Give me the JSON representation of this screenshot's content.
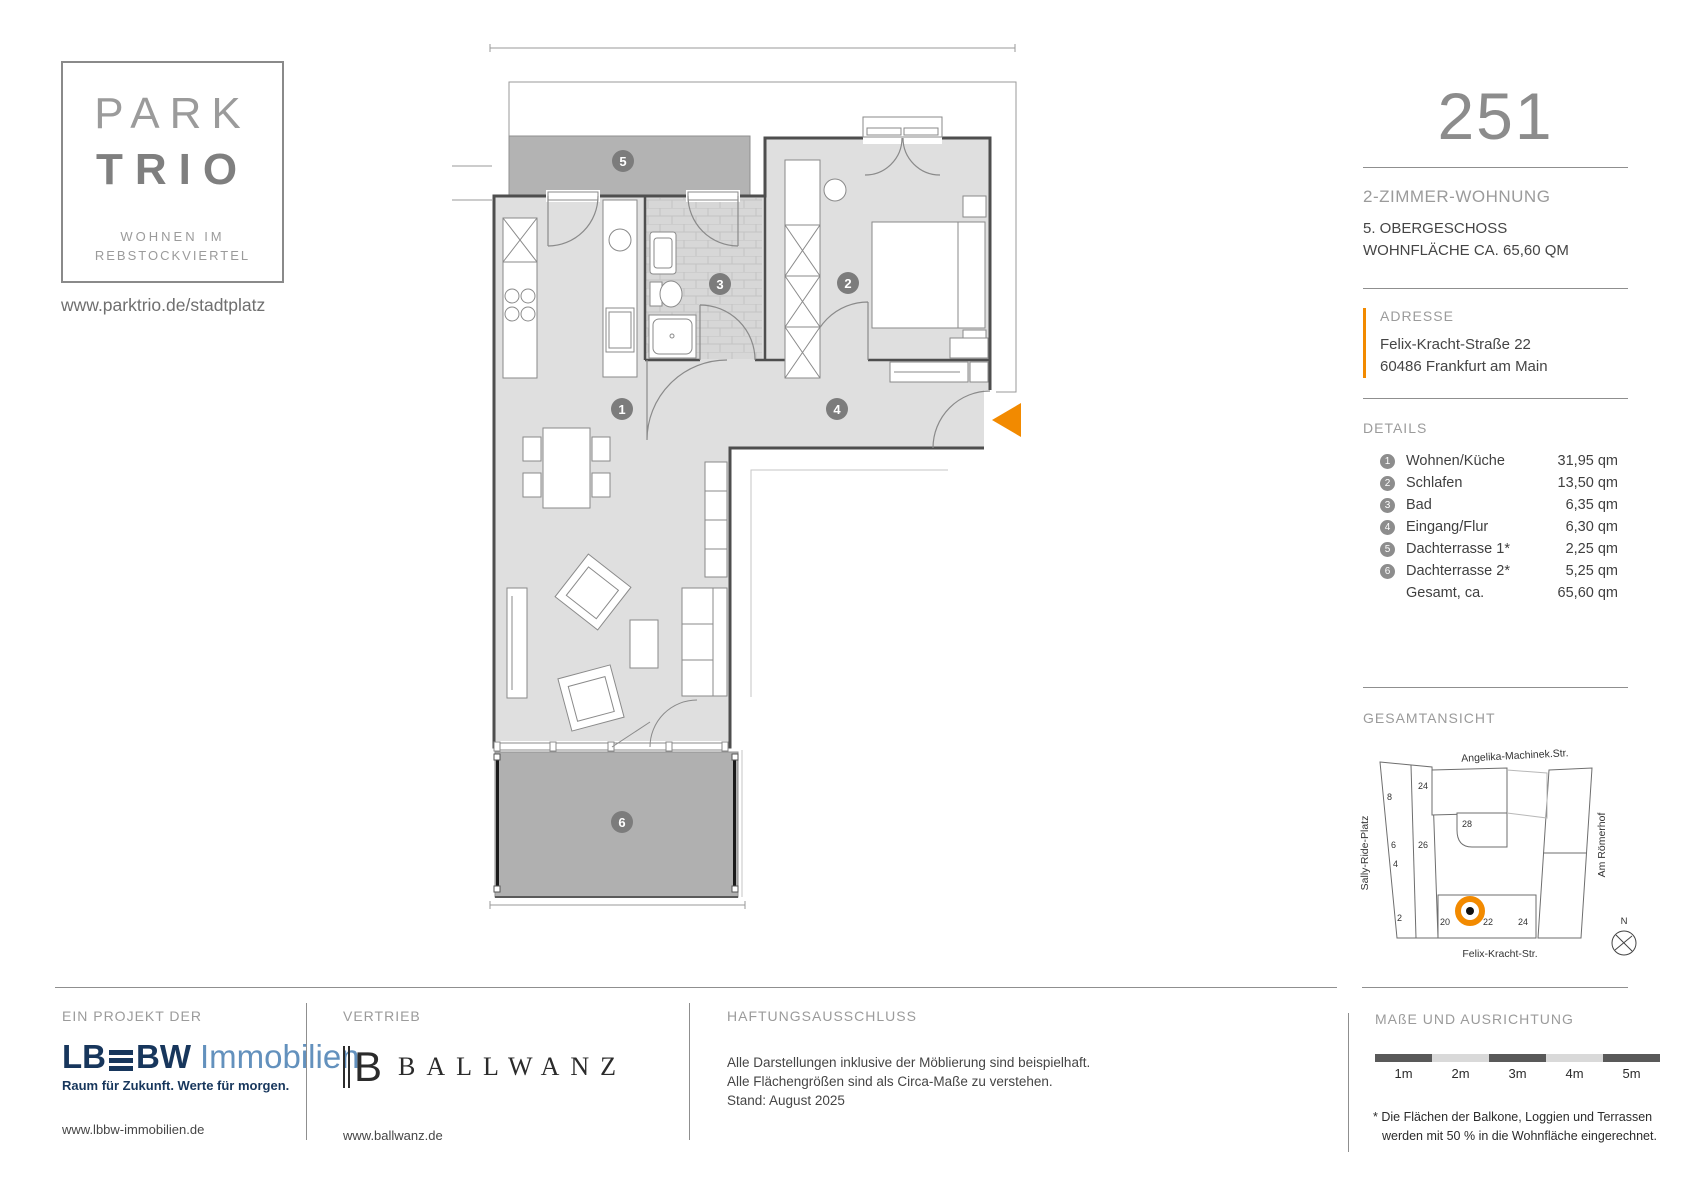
{
  "brand": {
    "logo_line1": "PARK",
    "logo_line2": "TRIO",
    "logo_sub1": "WOHNEN IM",
    "logo_sub2": "REBSTOCKVIERTEL",
    "website": "www.parktrio.de/stadtplatz"
  },
  "unit": {
    "number": "251",
    "type": "2-ZIMMER-WOHNUNG",
    "floor": "5. OBERGESCHOSS",
    "area_line": "WOHNFLÄCHE CA. 65,60 QM"
  },
  "address": {
    "label": "ADRESSE",
    "street": "Felix-Kracht-Straße 22",
    "city": "60486 Frankfurt am Main"
  },
  "details": {
    "label": "DETAILS",
    "rows": [
      {
        "num": "1",
        "name": "Wohnen/Küche",
        "area": "31,95 qm"
      },
      {
        "num": "2",
        "name": "Schlafen",
        "area": "13,50 qm"
      },
      {
        "num": "3",
        "name": "Bad",
        "area": "6,35 qm"
      },
      {
        "num": "4",
        "name": "Eingang/Flur",
        "area": "6,30 qm"
      },
      {
        "num": "5",
        "name": "Dachterrasse 1*",
        "area": "2,25 qm"
      },
      {
        "num": "6",
        "name": "Dachterrasse 2*",
        "area": "5,25 qm"
      }
    ],
    "total": {
      "name": "Gesamt, ca.",
      "area": "65,60 qm"
    }
  },
  "floorplan": {
    "badges": [
      "1",
      "2",
      "3",
      "4",
      "5",
      "6"
    ]
  },
  "overview": {
    "label": "GESAMTANSICHT",
    "street_top": "Angelika-Machinek.Str.",
    "street_left": "Sally-Ride-Platz",
    "street_right": "Am Römerhof",
    "street_bottom": "Felix-Kracht-Str.",
    "compass": "N",
    "numbers": {
      "n8": "8",
      "n6": "6",
      "n4": "4",
      "n2": "2",
      "n24a": "24",
      "n26": "26",
      "n28": "28",
      "n20": "20",
      "n22": "22",
      "n24b": "24"
    }
  },
  "footer": {
    "project_label": "EIN PROJEKT DER",
    "lbbw_lb": "LB",
    "lbbw_bw": "BW",
    "lbbw_immobilien": "Immobilien",
    "lbbw_tagline": "Raum für Zukunft. Werte für morgen.",
    "lbbw_url": "www.lbbw-immobilien.de",
    "sales_label": "VERTRIEB",
    "ballwanz_mark": "B",
    "ballwanz_name": "BALLWANZ",
    "ballwanz_url": "www.ballwanz.de",
    "disclaimer_label": "HAFTUNGSAUSSCHLUSS",
    "disclaimer_line1": "Alle Darstellungen inklusive der Möblierung sind beispielhaft.",
    "disclaimer_line2": "Alle Flächengrößen sind als Circa-Maße zu verstehen.",
    "disclaimer_line3": "Stand: August 2025",
    "measure_label": "MAßE UND AUSRICHTUNG",
    "scale_ticks": [
      "1m",
      "2m",
      "3m",
      "4m",
      "5m"
    ],
    "footnote_line1": "* Die Flächen der Balkone, Loggien und Terrassen",
    "footnote_line2": "werden mit 50 % in die Wohnfläche eingerechnet."
  },
  "colors": {
    "accent_orange": "#F28A00",
    "terrace_fill": "#B3B3B3",
    "room_fill": "#DFDFDF",
    "wall": "#4E4E4E",
    "lbbw_navy": "#17365C",
    "lbbw_blue": "#6391BD"
  }
}
